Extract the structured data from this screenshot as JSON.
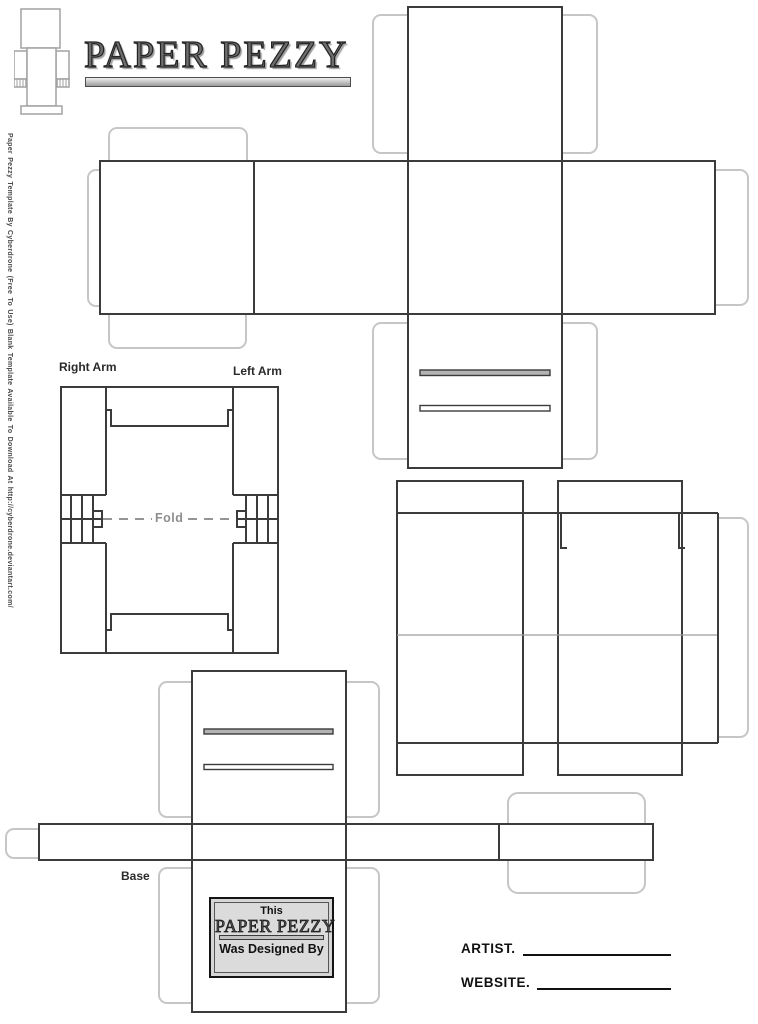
{
  "page": {
    "title": "PAPER PEZZY",
    "margin_note": "Paper Pezzy Template By Cyberdrone (Free To Use) Blank Template Available To Download At http://cyberdrone.deviantart.com/"
  },
  "labels": {
    "right_arm": "Right Arm",
    "left_arm": "Left Arm",
    "fold": "Fold",
    "base": "Base"
  },
  "designed_box": {
    "line1": "This",
    "logo": "PAPER PEZZY",
    "line2": "Was Designed By"
  },
  "credits": {
    "artist_label": "ARTIST.",
    "website_label": "WEBSITE."
  },
  "icons": {
    "figure": "paper-pezzy-figure-icon"
  },
  "colors": {
    "cut_line": "#3b3b3b",
    "glue_tab_line": "#c6c6c6",
    "fold_gray": "#949494",
    "title_bar_gray": "#9b9b9b",
    "designed_box_fill": "#d6d6d6",
    "slot_fill_dark": "#b3b3b3"
  }
}
